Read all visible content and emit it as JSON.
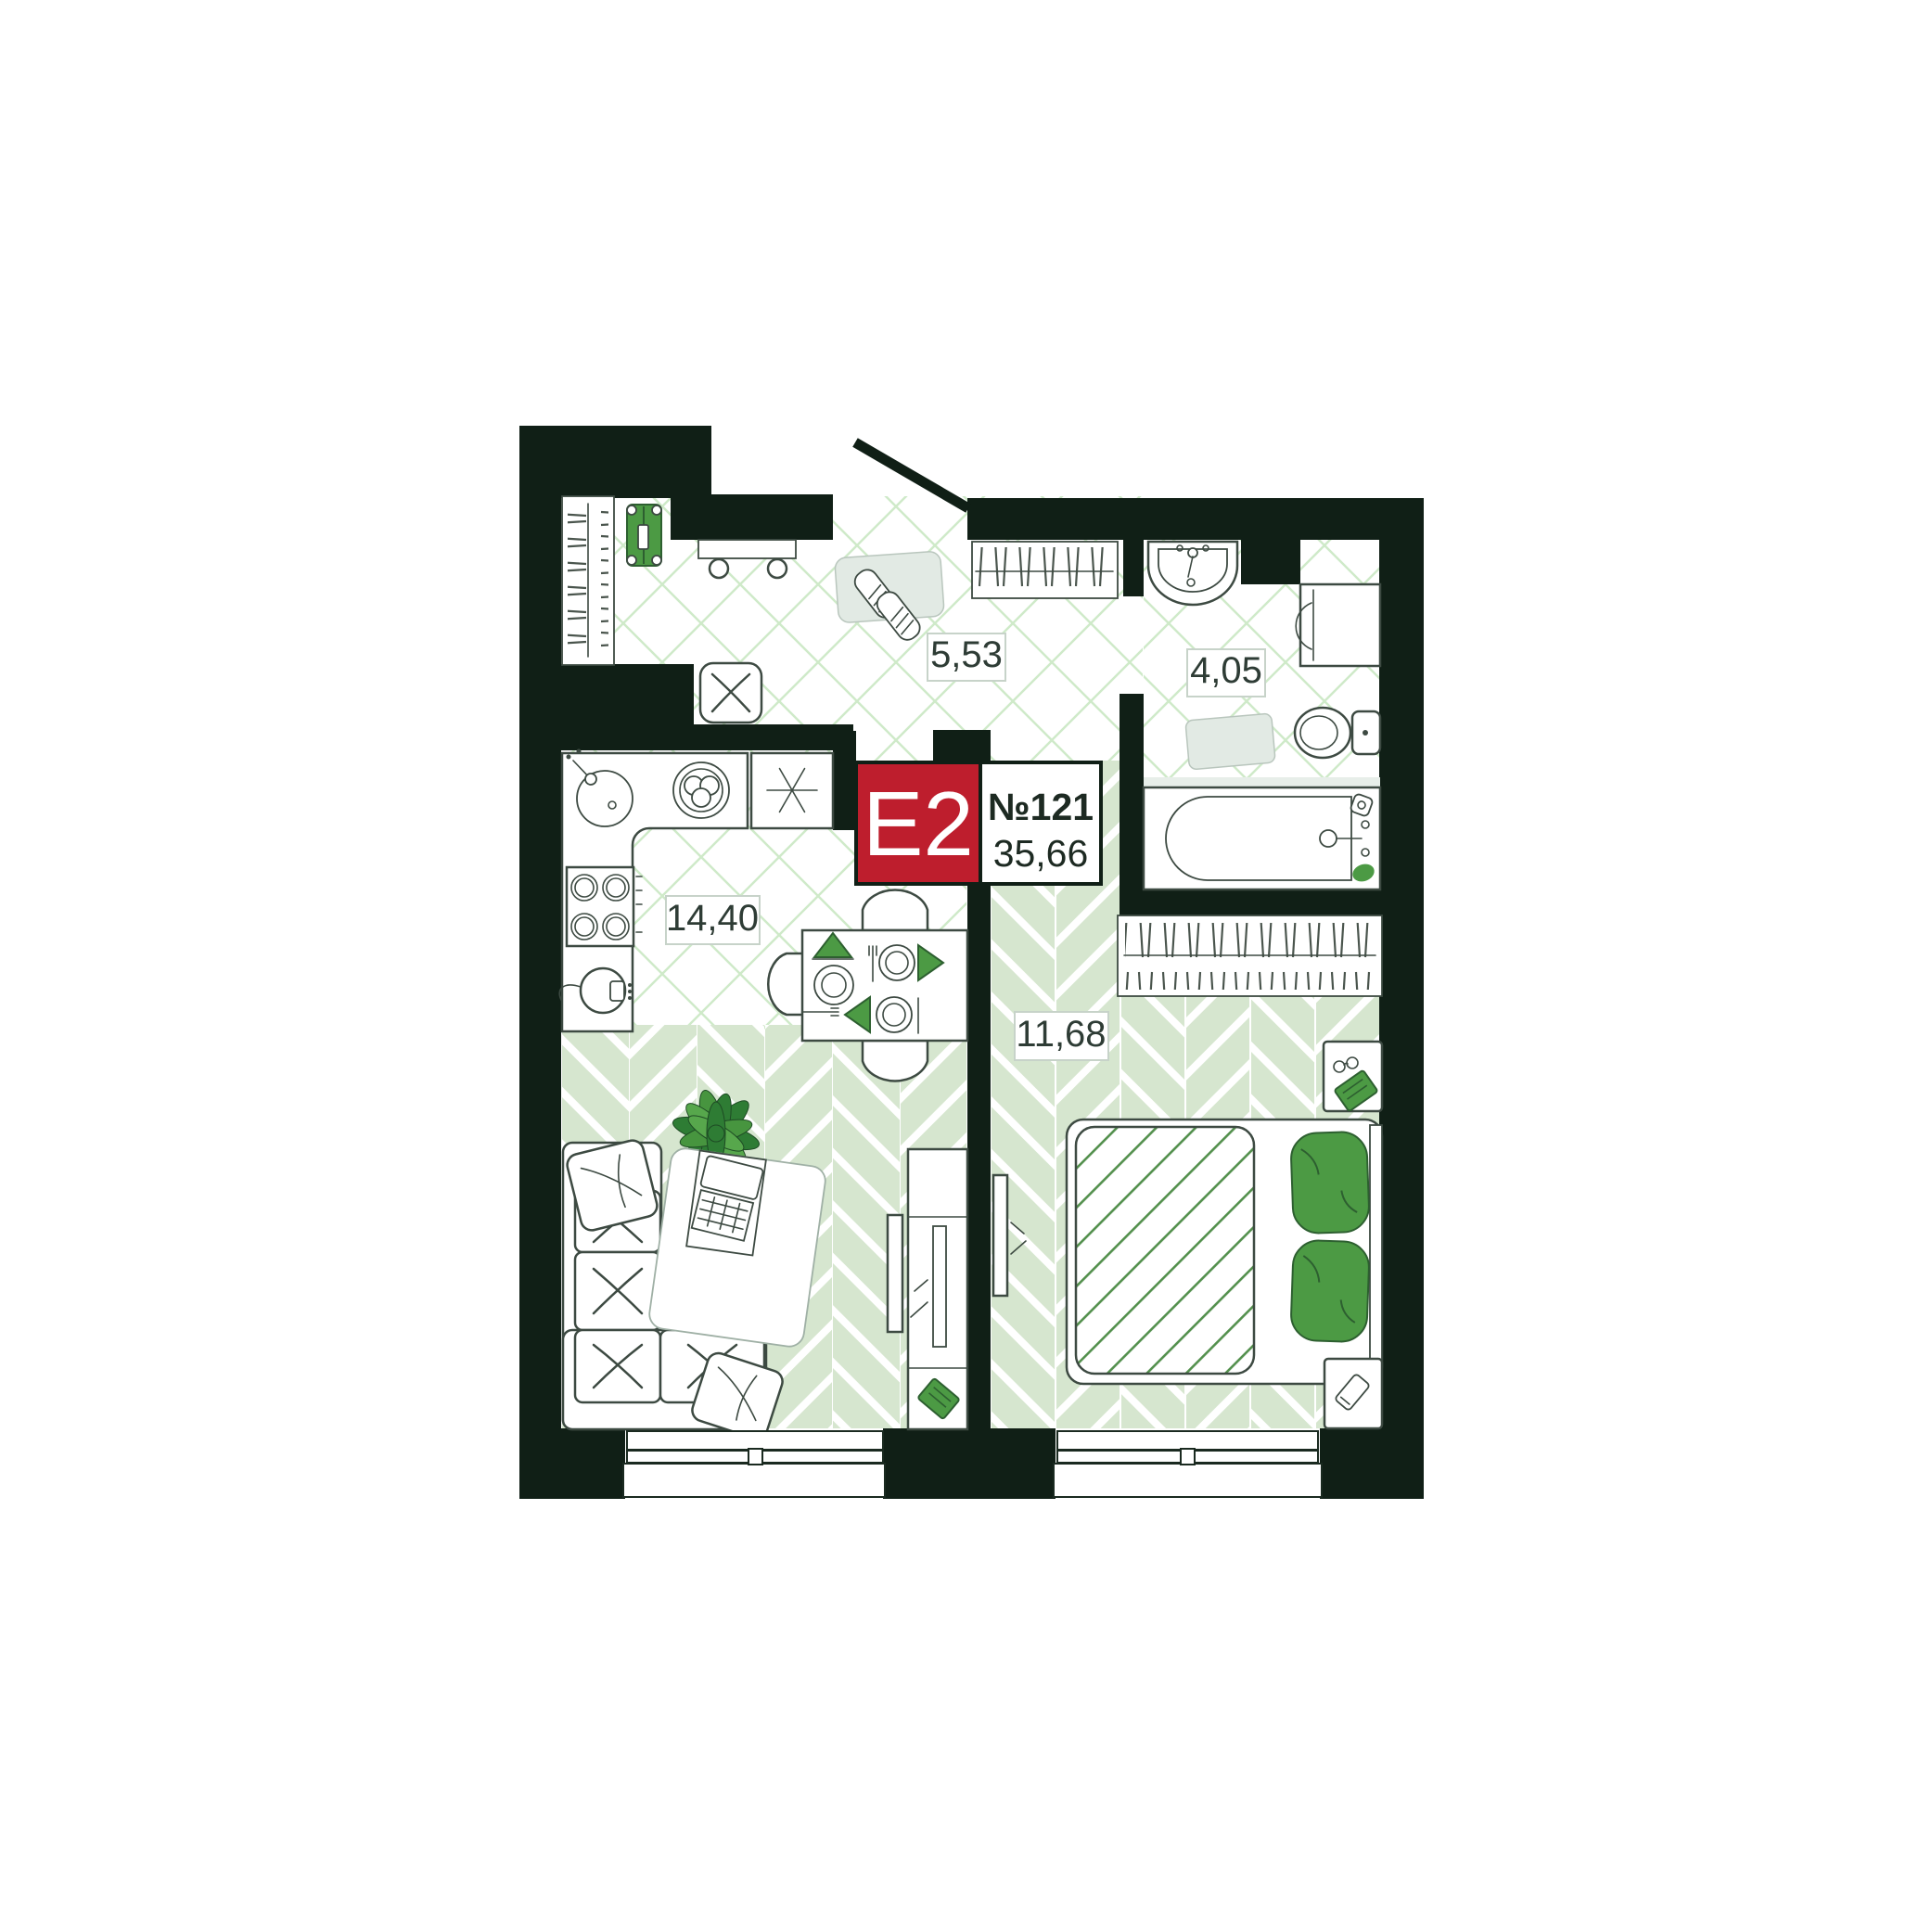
{
  "badge": {
    "layout_code": "E2",
    "apartment_number": "№121",
    "total_area": "35,66"
  },
  "rooms": [
    {
      "name": "hallway",
      "area": "5,53"
    },
    {
      "name": "bathroom",
      "area": "4,05"
    },
    {
      "name": "kitchen-living-room",
      "area": "14,40"
    },
    {
      "name": "bedroom",
      "area": "11,68"
    }
  ],
  "colors": {
    "wall": "#101f16",
    "badge_red": "#be1e2d",
    "accent_green": "#4c9a44",
    "floor_tile_line": "#cfeac9",
    "floor_plank": "#d6e6cf",
    "outline": "#3d4a42",
    "label_ink": "#2e3c35"
  }
}
